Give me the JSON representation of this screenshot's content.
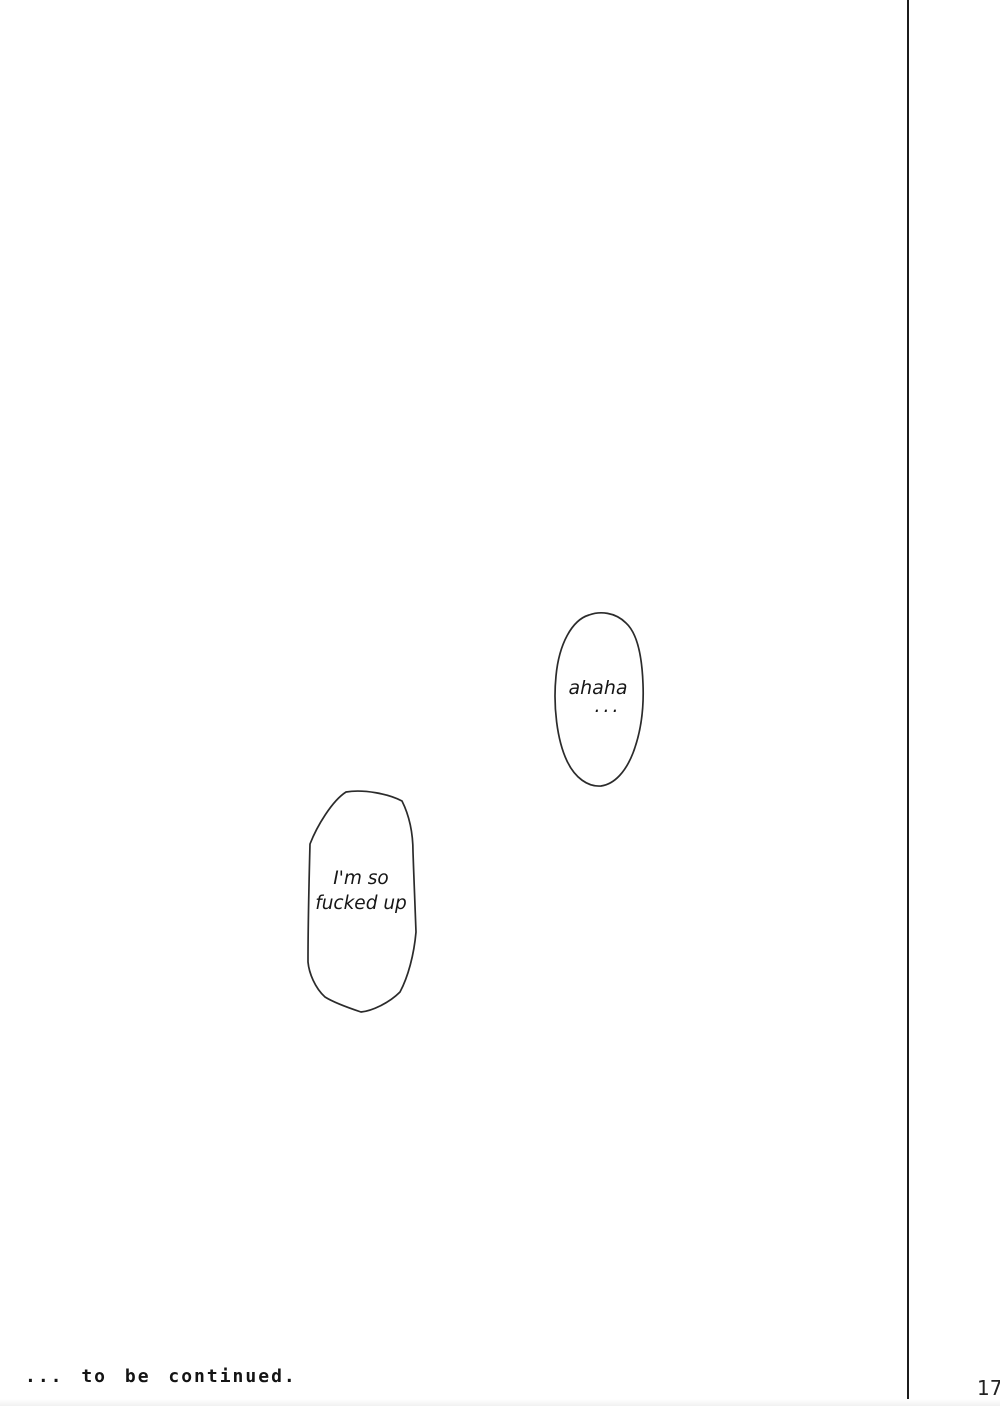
{
  "page": {
    "number": "17"
  },
  "footer": {
    "caption": "... to be continued."
  },
  "speech": {
    "bubble1": {
      "line1": "ahaha",
      "line2": "..."
    },
    "bubble2": {
      "line1": "I'm so",
      "line2": "fucked up"
    }
  },
  "colors": {
    "ink": "#1c1c1c",
    "paper": "#ffffff"
  }
}
